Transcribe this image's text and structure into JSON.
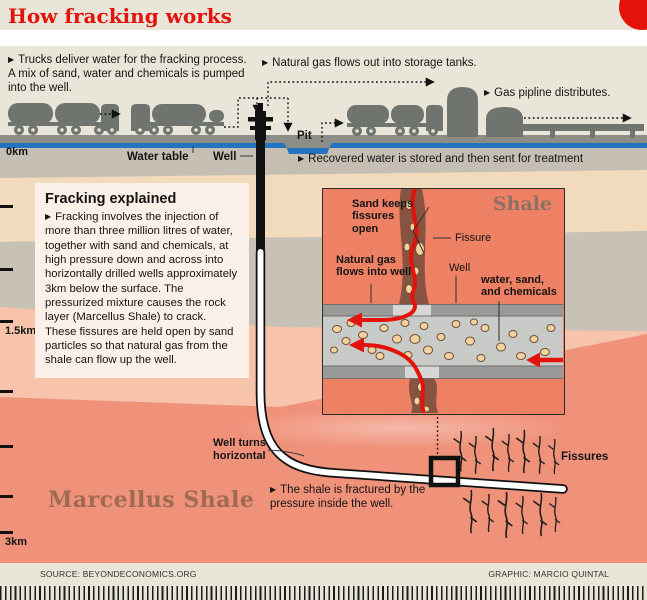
{
  "bullet": "▶",
  "header": {
    "title": "How fracking works"
  },
  "annotations": {
    "trucks": "Trucks deliver water for the fracking process. A mix of sand, water and chemicals is pumped into the well.",
    "gas_out": "Natural gas flows out into storage tanks.",
    "pipeline": "Gas pipline distributes.",
    "recovered": "Recovered water is stored and then sent for treatment",
    "fractured": "The shale is fractured by the pressure inside the well."
  },
  "surface_labels": {
    "water_table": "Water table",
    "well": "Well",
    "pit": "Pit"
  },
  "depth_scale": {
    "surface": "0km",
    "mid": "1.5km",
    "deep": "3km"
  },
  "explain": {
    "title": "Fracking explained",
    "body": "Fracking involves the injection of more than three million litres of water, together with sand and chemicals, at high pressure down and across into horizontally drilled wells approximately 3km below the surface. The pressurized mixture causes the rock layer (Marcellus Shale) to crack. These fissures are held open by sand particles so that natural gas from the shale can flow up the well."
  },
  "inset": {
    "region": "Shale",
    "sand": "Sand keeps fissures open",
    "fissure": "Fissure",
    "gas": "Natural gas flows into well",
    "well": "Well",
    "mixture": "water, sand, and chemicals"
  },
  "deep_labels": {
    "well_turns": "Well turns horizontal",
    "marcellus": "Marcellus Shale",
    "fissures": "Fissures"
  },
  "footer": {
    "source": "SOURCE: BEYONDECONOMICS.ORG",
    "credit": "GRAPHIC: MARCIO QUINTAL"
  },
  "colors": {
    "accent_red": "#e3120b",
    "water_blue": "#2274c0",
    "machinery_gray": "#6f746e",
    "shale_salmon": "#f0927a"
  }
}
